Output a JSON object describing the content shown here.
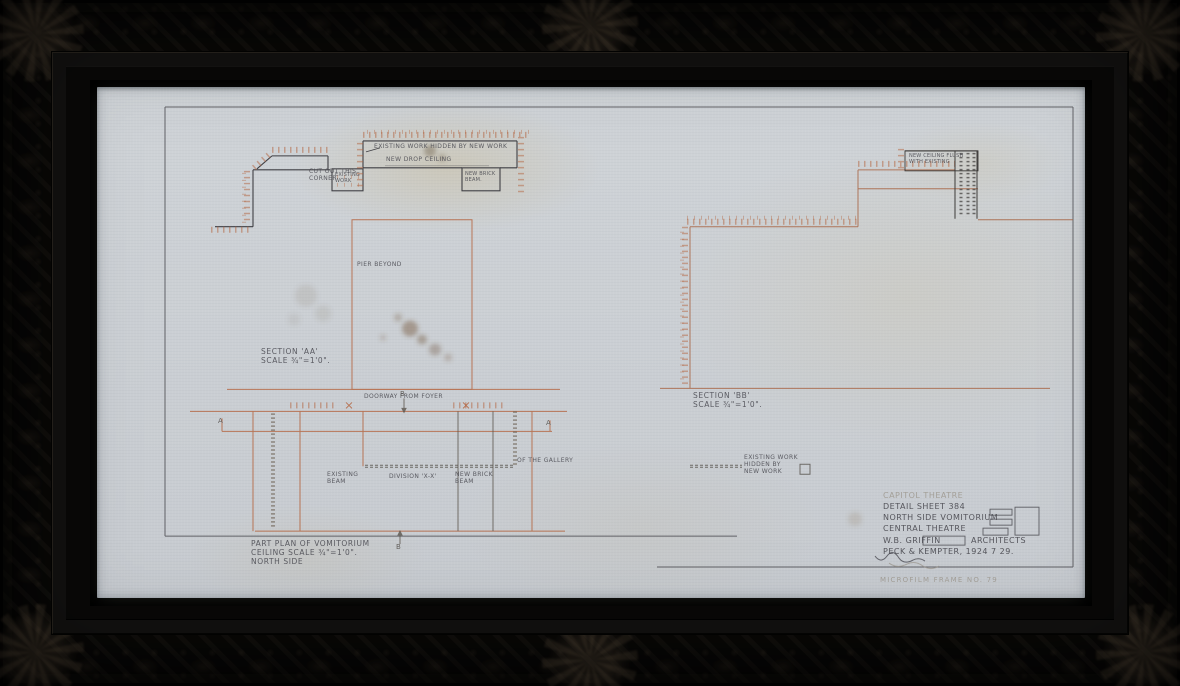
{
  "artwork": {
    "description": "Framed hand-drawn architectural detail sheet, ink and orange pencil on linen",
    "frame_style": "ornate carved black wood frame"
  },
  "colors": {
    "frame": "#0c0b09",
    "paper": "#cdd1d5",
    "ink": "#4b4b52",
    "orange_pencil": "#b4643f",
    "graphite_pencil": "#9a948a"
  },
  "labels": {
    "cut_out_corner": "CUT OUT THIS\nCORNER",
    "existing_work_box": "EXISTING\nWORK",
    "existing_work_hidden_top": "EXISTING WORK HIDDEN BY NEW WORK",
    "new_drop_ceiling": "NEW DROP CEILING",
    "new_brick_beam_top": "NEW BRICK\nBEAM.",
    "pier_beyond": "PIER BEYOND",
    "section_aa": "SECTION 'AA'\nSCALE ¾\"=1'0\".",
    "doorway_from_foyer": "DOORWAY FROM FOYER",
    "existing_beam": "EXISTING\nBEAM",
    "division_xx": "DIVISION 'X-X'",
    "new_brick_beam_plan": "NEW BRICK\nBEAM",
    "of_the_gallery": "OF THE GALLERY",
    "part_plan": "PART PLAN OF VOMITORIUM\nCEILING SCALE ¾\"=1'0\".\nNORTH SIDE",
    "section_bb": "SECTION 'BB'\nSCALE ¾\"=1'0\".",
    "existing_work_hidden_legend": "EXISTING WORK\nHIDDEN BY\nNEW WORK",
    "new_ceiling_flush": "NEW CEILING FLUSH\nWITH EXISTING"
  },
  "markers": {
    "a_left": "A",
    "a_right": "A",
    "b_top": "B",
    "b_bottom": "B"
  },
  "title_block": {
    "project_pencil": "CAPITOL THEATRE",
    "line1": "DETAIL SHEET 384",
    "line2": "NORTH SIDE VOMITORIUM",
    "line3": "CENTRAL THEATRE",
    "architect": "W.B. GRIFFIN",
    "architects_label": "ARCHITECTS",
    "firm_date": "PECK & KEMPTER, 1924 7 29."
  },
  "caption_pencil": "MICROFILM FRAME NO. 79"
}
